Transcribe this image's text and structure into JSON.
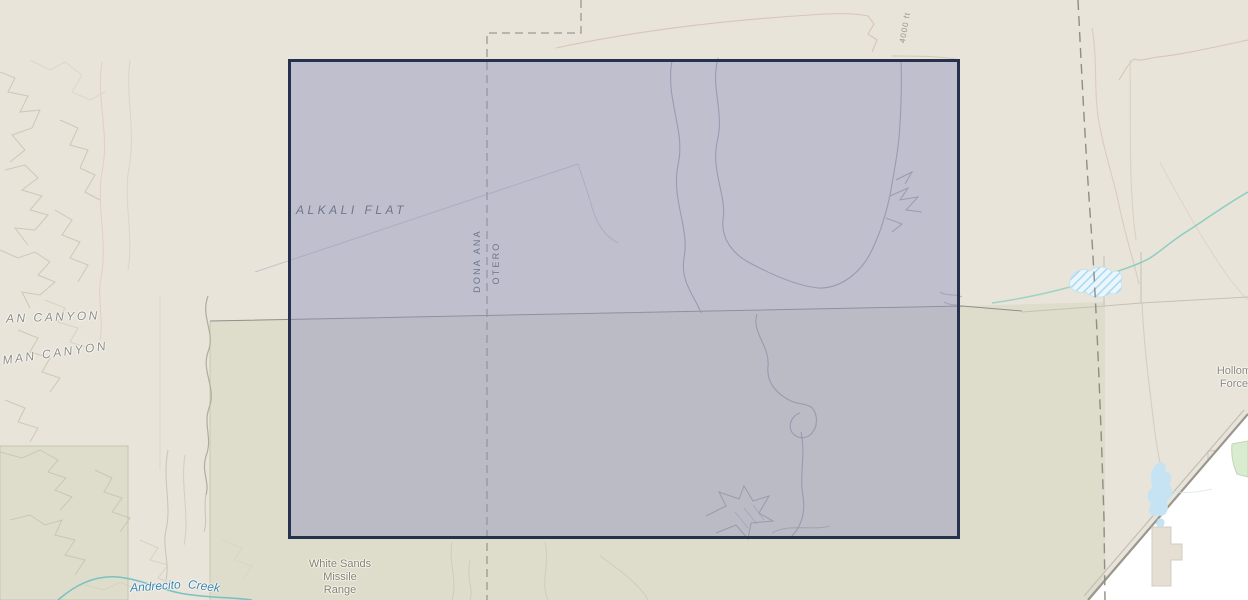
{
  "map": {
    "selection": {
      "x": 288,
      "y": 59,
      "width": 672,
      "height": 480,
      "fill": "rgba(143,146,188,0.45)",
      "border_color": "#25324e"
    },
    "labels": {
      "alkali_flat": "ALKALI FLAT",
      "county_left": "DONA ANA",
      "county_right": "OTERO",
      "canyon_upper": "AN CANYON",
      "canyon_lower": "MAN CANYON",
      "contour_elevation": "4000 ft",
      "range_line1": "White Sands",
      "range_line2": "Missile",
      "range_line3": "Range",
      "base_line1": "Holloman Air",
      "base_line2": "Force Base",
      "creek_word1": "Andrecito",
      "creek_word2": "Creek"
    },
    "colors": {
      "land": "#e8e4da",
      "range_tint": "rgba(199,205,168,0.30)",
      "water_fill": "#c5e3f3",
      "intermittent_water": "#a9d9f2",
      "stream": "#8fcdbf",
      "creek": "#79c2c2",
      "boundary_dash": "#9b9993",
      "contour": "#d8c5b7",
      "selection_fill": "rgba(143,146,188,0.45)",
      "selection_border": "#25324e",
      "white_area": "#ffffff"
    }
  }
}
